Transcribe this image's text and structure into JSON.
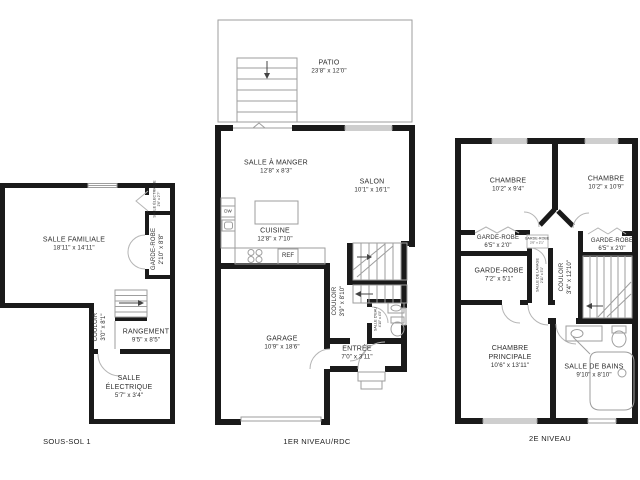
{
  "canvas": {
    "background": "#ffffff",
    "wall_color": "#1a1a1a",
    "line_color": "#9e9e9e",
    "text_color": "#2e2e2e"
  },
  "floors": {
    "basement": {
      "caption": "SOUS-SOL 1",
      "rooms": {
        "familiale": {
          "name": "SALLE FAMILIALE",
          "dims": "18'11\" x 14'11\""
        },
        "elec_small": {
          "name": "SALLE ÉLECTRIQUE",
          "dims": "2'6\" x 2'7\""
        },
        "garde_robe": {
          "name": "GARDE-ROBE",
          "dims": "2'10\" x 8'8\""
        },
        "couloir": {
          "name": "COULOIR",
          "dims": "3'0\" x 8'1\""
        },
        "rangement": {
          "name": "RANGEMENT",
          "dims": "9'5\" x 8'5\""
        },
        "elec": {
          "name": "SALLE ÉLECTRIQUE",
          "dims": "5'7\" x 3'4\""
        }
      }
    },
    "rdc": {
      "caption": "1ER NIVEAU/RDC",
      "rooms": {
        "patio": {
          "name": "PATIO",
          "dims": "23'8\" x 12'0\""
        },
        "salle_a_manger": {
          "name": "SALLE À MANGER",
          "dims": "12'8\" x 8'3\""
        },
        "salon": {
          "name": "SALON",
          "dims": "10'1\" x 16'1\""
        },
        "cuisine": {
          "name": "CUISINE",
          "dims": "12'8\" x 7'10\""
        },
        "garage": {
          "name": "GARAGE",
          "dims": "10'9\" x 18'6\""
        },
        "couloir": {
          "name": "COULOIR",
          "dims": "3'9\" x 8'10\""
        },
        "salle_eau": {
          "name": "SALLE D'EAU",
          "dims": "4'10\" x 4'5\""
        },
        "entree": {
          "name": "ENTRÉE",
          "dims": "7'0\" x 3'11\""
        }
      },
      "appliances": {
        "dishwasher": "DW",
        "fridge": "REF"
      }
    },
    "etage": {
      "caption": "2E NIVEAU",
      "rooms": {
        "chambre1": {
          "name": "CHAMBRE",
          "dims": "10'2\" x 9'4\""
        },
        "chambre2": {
          "name": "CHAMBRE",
          "dims": "10'2\" x 10'9\""
        },
        "gr1": {
          "name": "GARDE-ROBE",
          "dims": "6'5\" x 2'0\""
        },
        "gr2": {
          "name": "GARDE-ROBE",
          "dims": "6'5\" x 2'0\""
        },
        "gr_small": {
          "name": "GARDE-ROBE",
          "dims": "2'0\" x 2'1\""
        },
        "gr3": {
          "name": "GARDE-ROBE",
          "dims": "7'2\" x 5'1\""
        },
        "lavage": {
          "name": "SALLE DE LAVAGE",
          "dims": "2'11\" x 5'1\""
        },
        "couloir": {
          "name": "COULOIR",
          "dims": "3'4\" x 12'10\""
        },
        "principale": {
          "name": "CHAMBRE PRINCIPALE",
          "dims": "10'6\" x 13'11\""
        },
        "sdb": {
          "name": "SALLE DE BAINS",
          "dims": "9'10\" x 8'10\""
        }
      }
    }
  }
}
